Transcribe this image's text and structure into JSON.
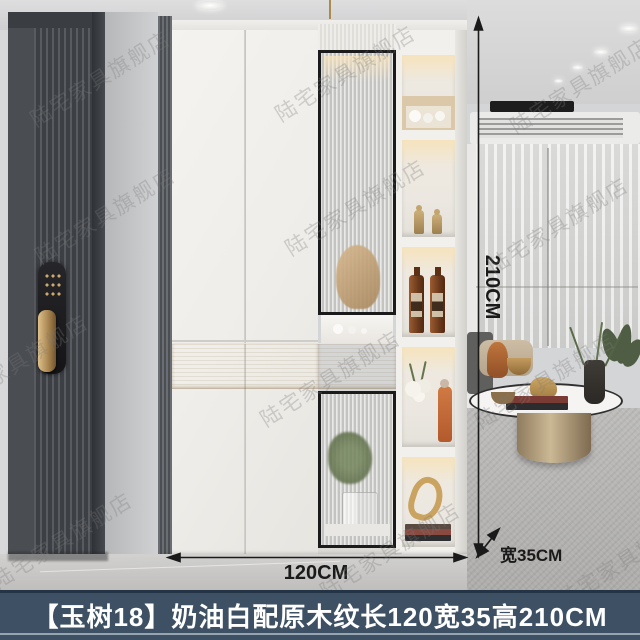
{
  "caption": {
    "text": "【玉树18】奶油白配原木纹长120宽35高210CM"
  },
  "dimensions": {
    "height": "210CM",
    "width": "120CM",
    "depth": "宽35CM"
  },
  "watermark": {
    "text": "陆宅家具旗舰店"
  },
  "colors": {
    "caption_bg": "#3e5164",
    "caption_text": "#ffffff",
    "wood": "#d9c098",
    "annotation": "#1a1a1a",
    "led_glow": "#f6e3bd"
  }
}
